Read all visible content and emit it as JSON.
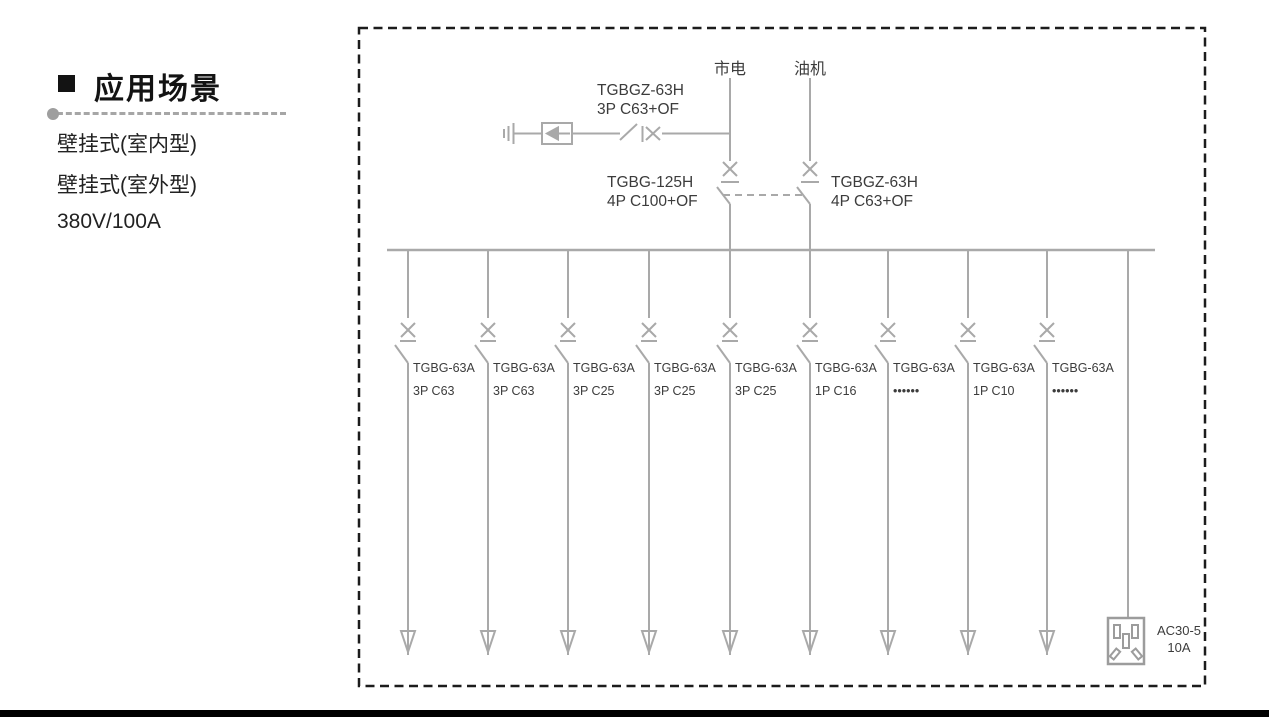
{
  "section": {
    "title": "应用场景",
    "items": [
      "壁挂式(室内型)",
      "壁挂式(室外型)",
      "380V/100A"
    ]
  },
  "diagram": {
    "mains_label": "市电",
    "generator_label": "油机",
    "spd_breaker": {
      "model": "TGBGZ-63H",
      "rating": "3P C63+OF"
    },
    "mains_breaker": {
      "model": "TGBG-125H",
      "rating": "4P C100+OF"
    },
    "generator_breaker": {
      "model": "TGBGZ-63H",
      "rating": "4P C63+OF"
    },
    "branches": [
      {
        "model": "TGBG-63A",
        "rating": "3P C63"
      },
      {
        "model": "TGBG-63A",
        "rating": "3P C63"
      },
      {
        "model": "TGBG-63A",
        "rating": "3P C25"
      },
      {
        "model": "TGBG-63A",
        "rating": "3P C25"
      },
      {
        "model": "TGBG-63A",
        "rating": "3P C25"
      },
      {
        "model": "TGBG-63A",
        "rating": "1P C16"
      },
      {
        "model": "TGBG-63A",
        "rating": "••••••"
      },
      {
        "model": "TGBG-63A",
        "rating": "1P C10"
      },
      {
        "model": "TGBG-63A",
        "rating": "••••••"
      }
    ],
    "socket": {
      "model": "AC30-5",
      "rating": "10A"
    }
  },
  "colors": {
    "diagram_line": "#a9a9a9",
    "diagram_text": "#3c3c3c",
    "dashed_border": "#1c1c1c",
    "bottom_bar": "#000000"
  }
}
